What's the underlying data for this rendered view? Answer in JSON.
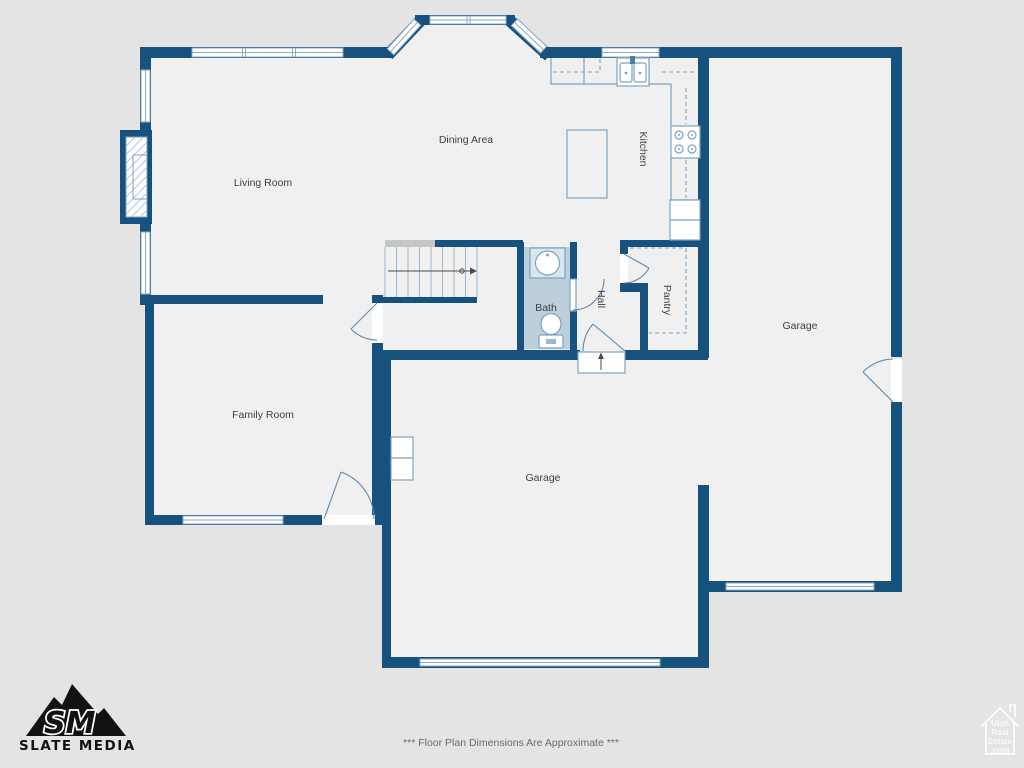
{
  "rooms": {
    "living_room": "Living Room",
    "dining_area": "Dining Area",
    "kitchen": "Kitchen",
    "bath": "Bath",
    "hall": "Hall",
    "pantry": "Pantry",
    "garage_right": "Garage",
    "garage_main": "Garage",
    "family_room": "Family Room"
  },
  "footer": {
    "disclaimer": "*** Floor Plan Dimensions Are Approximate ***"
  },
  "branding": {
    "monogram": "SM",
    "name": "SLATE MEDIA"
  },
  "watermark": {
    "line1": "Utah",
    "line2": "Real",
    "line3": "Estate",
    "line4": ".com"
  },
  "icons": {
    "stair_direction_arrow": "right-arrow",
    "entry_step_arrow": "up-arrow"
  },
  "colors": {
    "wall": "#17527f",
    "fixture": "#7ba3c4",
    "bath_fill": "#bccfdb",
    "floor": "#f0f0f0",
    "background": "#e4e4e4",
    "label": "#3f3f3f",
    "logo": "#121212"
  }
}
